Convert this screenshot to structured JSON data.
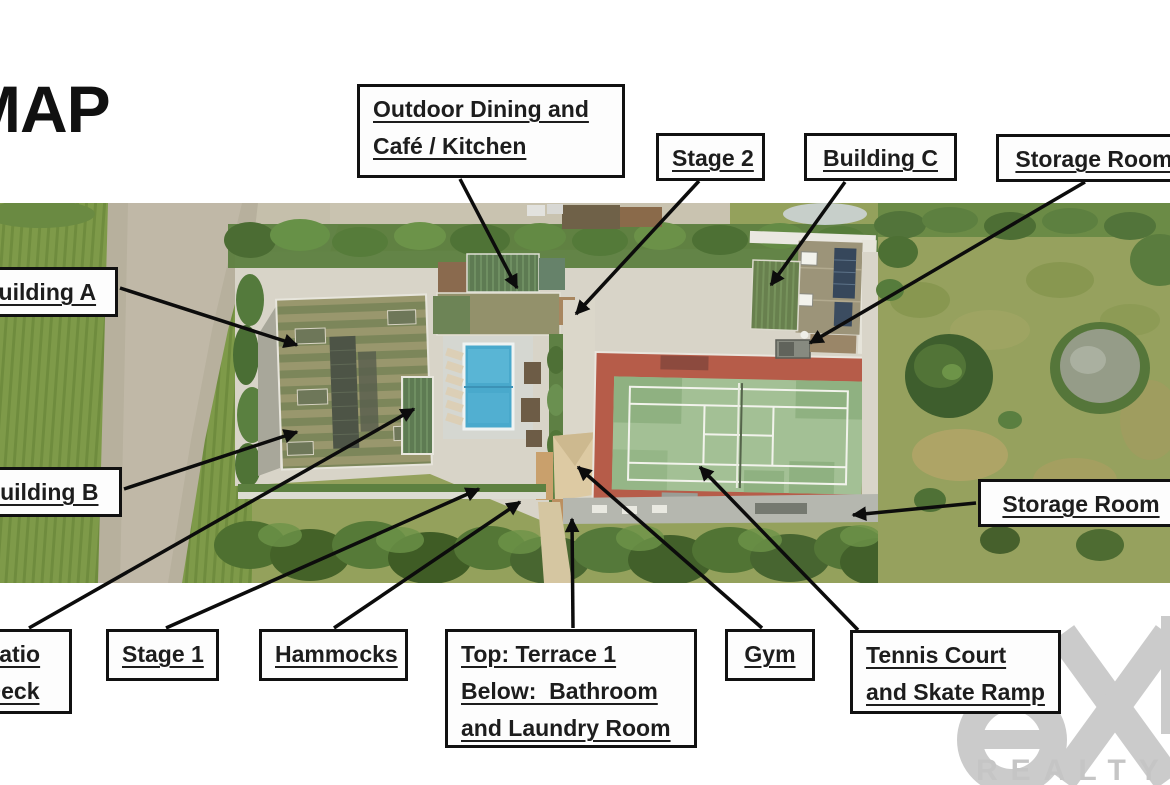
{
  "page": {
    "title": "MAP"
  },
  "map_labels": {
    "outdoor_dining": {
      "line1": "Outdoor Dining and",
      "line2": "Café / Kitchen"
    },
    "stage_2": {
      "label": "Stage 2"
    },
    "building_c": {
      "label": "Building C"
    },
    "storage_room_top": {
      "label": "Storage Room"
    },
    "building_a": {
      "label": "Building A"
    },
    "building_b": {
      "label": "Building B"
    },
    "storage_room_right": {
      "label": "Storage Room"
    },
    "patio_deck": {
      "line1": "Patio",
      "line2": "Deck"
    },
    "stage_1": {
      "label": "Stage 1"
    },
    "hammocks": {
      "label": "Hammocks"
    },
    "terrace_bathroom_laundry": {
      "line1": "Top: Terrace 1",
      "line2": "Below:  Bathroom",
      "line3": "and Laundry Room"
    },
    "gym": {
      "label": "Gym"
    },
    "tennis_skate": {
      "line1": "Tennis Court",
      "line2": "and Skate Ramp"
    }
  },
  "watermark": {
    "brand_visible": "ex",
    "realty": "REALTY"
  },
  "colors": {
    "label_border": "#111111",
    "label_bg": "#fdfdfd",
    "arrow": "#0c0c0c",
    "watermark_gray": "#c9c9c9",
    "pool_blue": "#49a9cc",
    "tennis_red": "#b65c49",
    "tennis_court_green": "#a3c095"
  }
}
